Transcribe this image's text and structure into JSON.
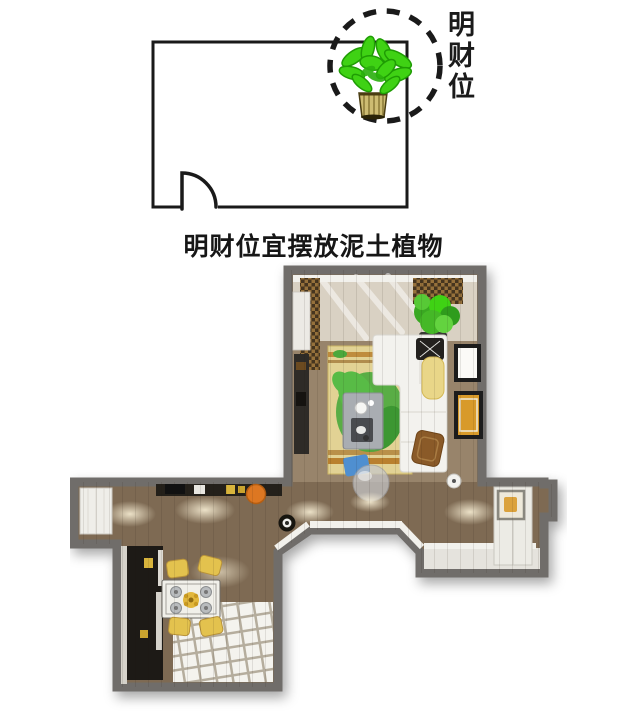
{
  "diagram": {
    "label_vertical": "明财位",
    "caption": "明财位宜摆放泥土植物"
  },
  "icons": {
    "plant": "potted-plant-icon",
    "wealth_marker": "dashed-circle-marker",
    "door": "door-swing-symbol"
  },
  "colors": {
    "line_black": "#1a1a1a",
    "plant_green": "#3fd214",
    "plant_green_dark": "#1f9c04",
    "pot_tan": "#cdbc72",
    "pot_outline": "#4a3d12",
    "wall_gray": "#6f6d6a",
    "floor_wood": "#7e6b52",
    "floor_wood_light": "#98846b",
    "living_beige": "#d9d1c3",
    "rug_yellow": "#e2d294",
    "rug_stripe": "#b9802e",
    "leaf_green": "#4aa83c",
    "leaf_green_light": "#58bb46",
    "sofa_white": "#f3f2ee",
    "counter_black": "#24201a",
    "cabinet_black": "#1d1a16",
    "stool_orange": "#dd7722",
    "chair_yellow": "#e3c24e",
    "cushion_blue": "#4f8fd0",
    "chair_brown": "#8a5a28",
    "tile_white": "#f4f3ee",
    "tile_grout": "#b5ad9d",
    "alcove_floor": "#e5e3dd",
    "frame_black": "#1c1c1c",
    "art_orange": "#d89a2a",
    "table_gray": "#a9adb2",
    "throw_yellow": "#e9d688",
    "white_trim": "#f2f1ec",
    "curtain_dark": "#46351f",
    "curtain_light": "#96713b"
  }
}
